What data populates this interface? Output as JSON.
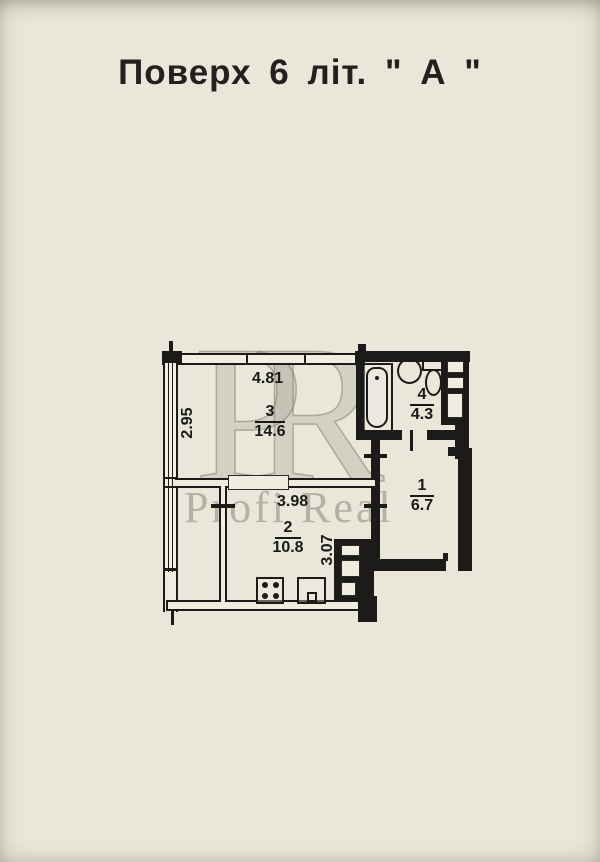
{
  "page": {
    "title": "Поверх 6 літ. \" А \""
  },
  "watermark": {
    "monogram": "PR",
    "text": "Profi Real"
  },
  "plan": {
    "rooms": [
      {
        "number": "1",
        "area": "6.7"
      },
      {
        "number": "2",
        "area": "10.8"
      },
      {
        "number": "3",
        "area": "14.6"
      },
      {
        "number": "4",
        "area": "4.3"
      }
    ],
    "dims": {
      "room3_width": "4.81",
      "room3_depth": "2.95",
      "room2_width": "3.98",
      "room2_depth": "3.07"
    }
  }
}
